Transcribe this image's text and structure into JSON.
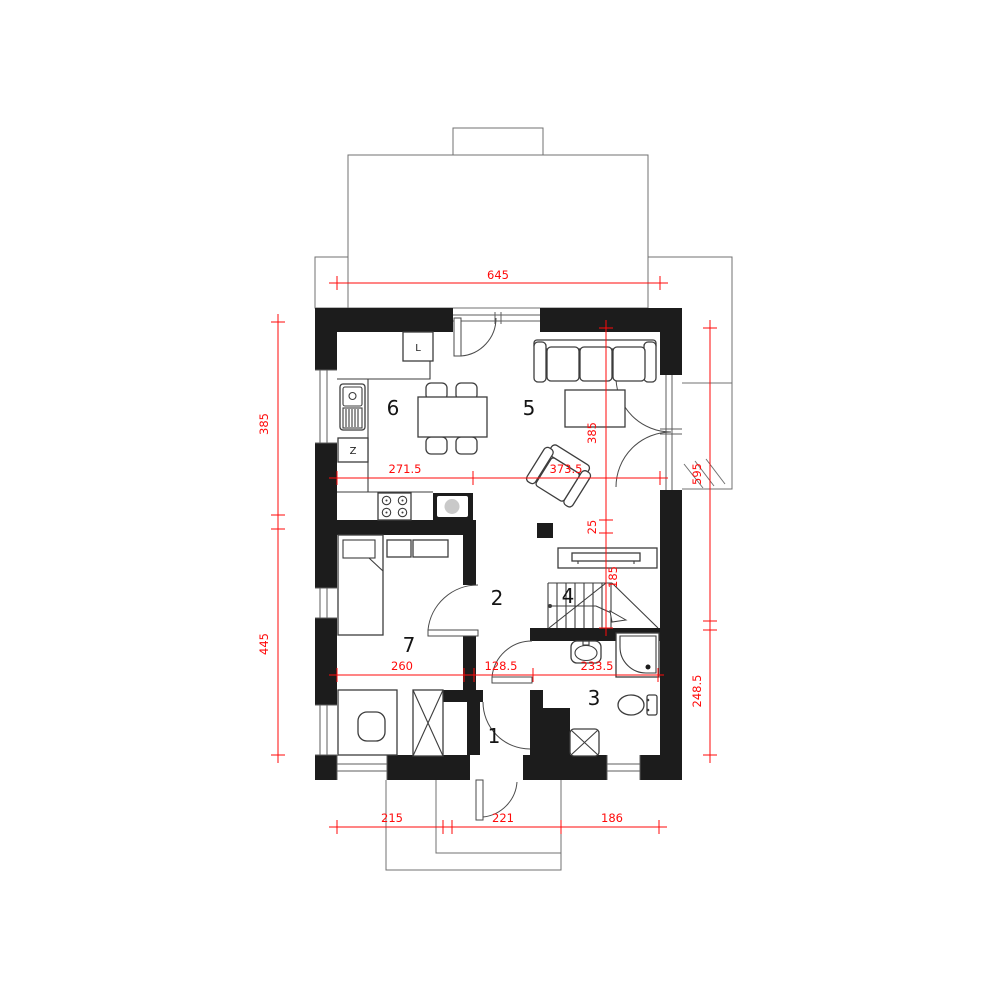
{
  "rooms": {
    "vestibule": "1",
    "hall": "2",
    "bathroom": "3",
    "stairs": "4",
    "living": "5",
    "kitchen": "6",
    "bedroom": "7"
  },
  "kitchen": {
    "fridge": "L",
    "dishwasher": "Z"
  },
  "dimensions": {
    "total_width": "645",
    "kitchen_width": "271.5",
    "living_width": "373.5",
    "living_depth": "385",
    "pillar_gap": "25",
    "stair_depth": "185",
    "bedroom_width": "260",
    "hall_width": "128.5",
    "bathroom_width": "233.5",
    "bottom_left": "215",
    "bottom_mid": "221",
    "bottom_right": "186",
    "left_upper": "385",
    "left_lower": "445",
    "right_upper": "595",
    "right_lower": "248.5"
  },
  "colors": {
    "wall": "#1c1c1c",
    "dimension": "#ff0a0a",
    "outline": "#707070",
    "background": "#ffffff"
  }
}
